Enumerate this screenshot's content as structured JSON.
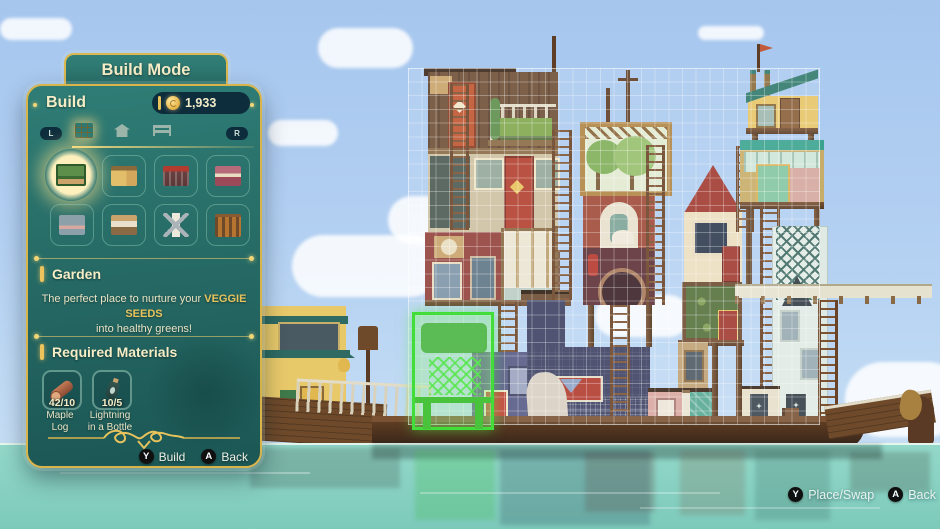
{
  "panel": {
    "mode_title": "Build Mode",
    "section_label": "Build",
    "currency": {
      "amount": "1,933",
      "icon": "glim-coin"
    },
    "tabs": {
      "left_bumper": "L",
      "right_bumper": "R",
      "items": [
        {
          "icon": "building-tab",
          "selected": true
        },
        {
          "icon": "house-tab",
          "selected": false
        },
        {
          "icon": "furniture-tab",
          "selected": false
        }
      ]
    },
    "grid_items": [
      {
        "icon": "garden-thumbnail",
        "selected": true
      },
      {
        "icon": "guesthouse-thumbnail",
        "selected": false
      },
      {
        "icon": "kitchen-thumbnail",
        "selected": false
      },
      {
        "icon": "shop-thumbnail",
        "selected": false
      },
      {
        "icon": "module-thumbnail",
        "selected": false
      },
      {
        "icon": "bedroom-thumbnail",
        "selected": false
      },
      {
        "icon": "windmill-thumbnail",
        "selected": false
      },
      {
        "icon": "corral-thumbnail",
        "selected": false
      }
    ],
    "selected_item": {
      "name": "Garden",
      "desc_prefix": "The perfect place to nurture your ",
      "desc_highlight": "VEGGIE SEEDS",
      "desc_suffix": "into healthy greens!"
    },
    "materials_title": "Required Materials",
    "materials": [
      {
        "label1": "Maple",
        "label2": "Log",
        "count": "42/10",
        "icon": "maple-log"
      },
      {
        "label1": "Lightning",
        "label2": "in a Bottle",
        "count": "10/5",
        "icon": "lightning-bottle"
      }
    ],
    "prompts": [
      {
        "key": "Y",
        "label": "Build"
      },
      {
        "key": "A",
        "label": "Back"
      }
    ]
  },
  "hud": {
    "prompts": [
      {
        "key": "Y",
        "label": "Place/Swap"
      },
      {
        "key": "A",
        "label": "Back"
      }
    ]
  },
  "colors": {
    "accent_gold": "#e8c35c",
    "panel_teal": "#276b66",
    "placement_green": "#42dd38",
    "sky": "#a6c6ee",
    "water": "#8ad2c4"
  }
}
